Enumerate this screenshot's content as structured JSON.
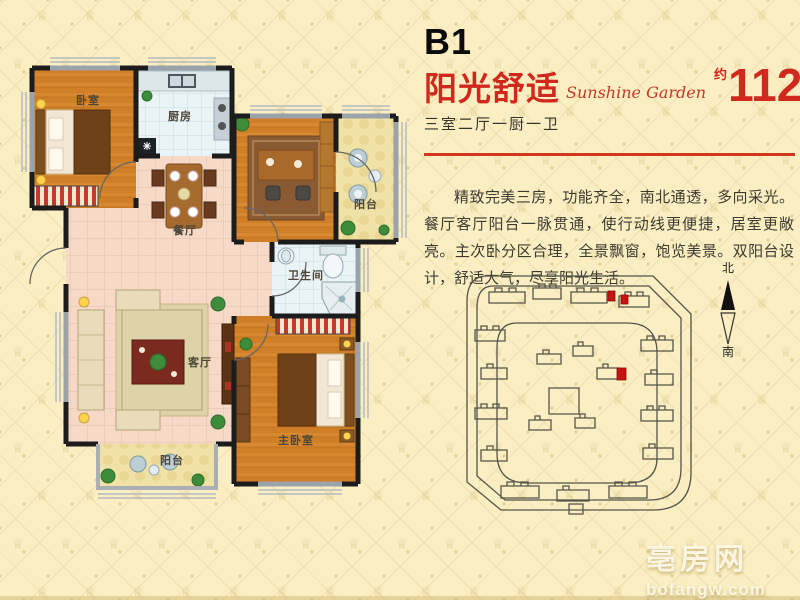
{
  "header": {
    "plan_code": "B1",
    "title_cn": "阳光舒适",
    "title_en": "Sunshine Garden",
    "area_prefix": "约",
    "area_value": "112",
    "area_unit": "m",
    "area_exponent": "2",
    "layout_summary": "三室二厅一厨一卫"
  },
  "description": "精致完美三房，功能齐全，南北通透，多向采光。餐厅客厅阳台一脉贯通，使行动线更便捷，居室更敞亮。主次卧分区合理，全景飘窗，饱览美景。双阳台设计，舒适大气，尽享阳光生活。",
  "floor_plan": {
    "labels": {
      "bedroom": "卧室",
      "kitchen": "厨房",
      "dining": "餐厅",
      "balcony_top": "阳台",
      "bathroom": "卫生间",
      "living": "客厅",
      "balcony_bottom": "阳台",
      "master_bedroom": "主卧室"
    }
  },
  "site_map": {
    "north_label": "北",
    "south_label": "南",
    "highlight_color": "#c41410"
  },
  "watermark": {
    "brand": "亳房网",
    "domain": "bofangw.com"
  },
  "colors": {
    "accent_red": "#d0281c",
    "line_red": "#cf3a1e",
    "text_dark": "#3c3b30"
  },
  "decor": {
    "crown_glyph": "♕"
  }
}
